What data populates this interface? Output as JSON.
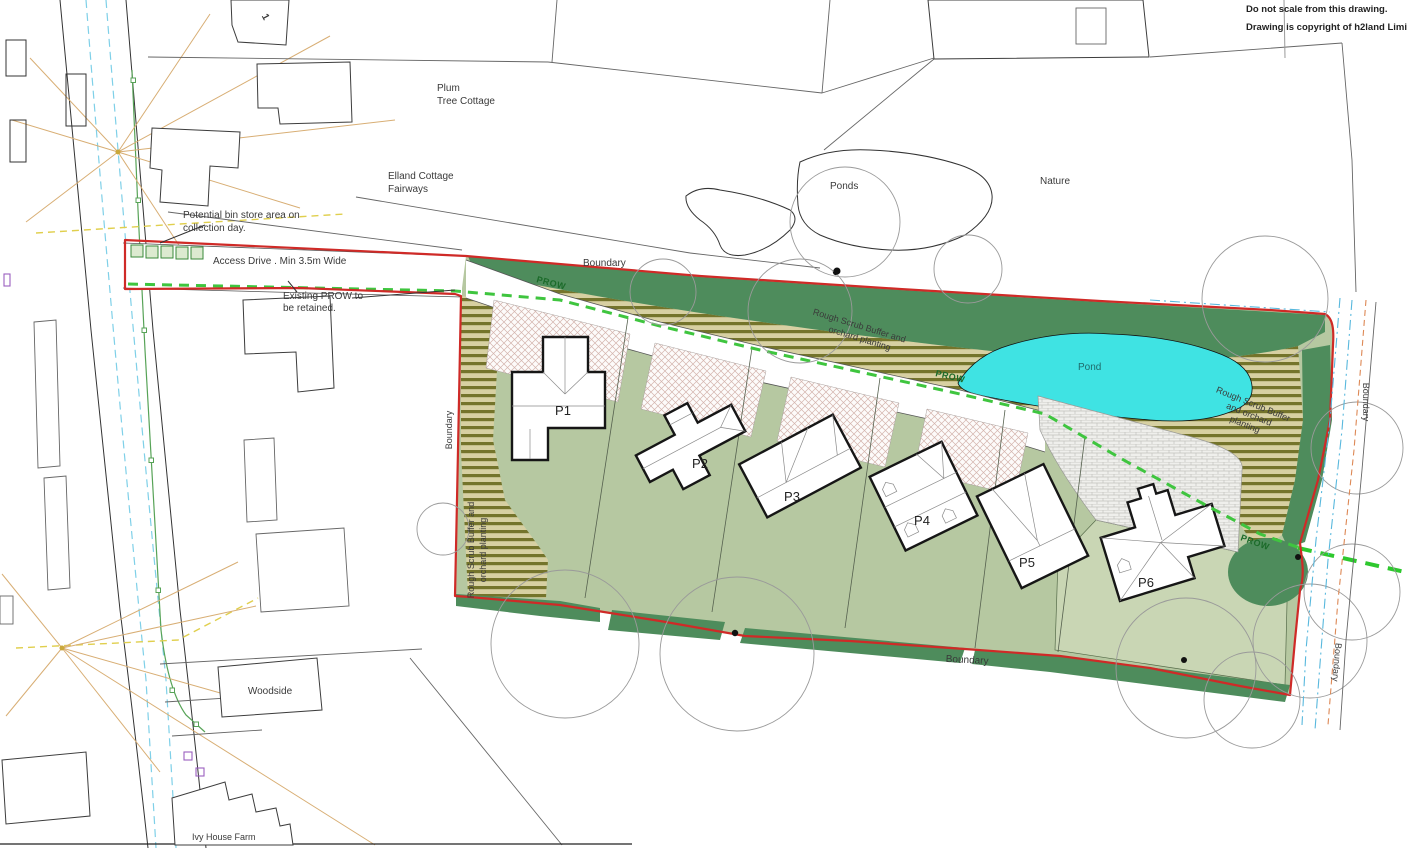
{
  "title_notes": {
    "line1": "Do not scale from this drawing.",
    "line2": "Drawing is copyright of h2land Limited"
  },
  "context_labels": {
    "house_number": "1",
    "plum_line1": "Plum",
    "plum_line2": "Tree Cottage",
    "elland_line1": "Elland Cottage",
    "elland_line2": "Fairways",
    "ponds": "Ponds",
    "nature": "Nature",
    "woodside": "Woodside",
    "ivy_house_farm": "Ivy House Farm"
  },
  "site_labels": {
    "bin_line1": "Potential bin store area on",
    "bin_line2": "collection day.",
    "access_drive": "Access Drive . Min 3.5m Wide",
    "prow_retained_line1": "Existing PROW to",
    "prow_retained_line2": "be retained.",
    "boundary": "Boundary",
    "prow": "PROW",
    "pond": "Pond",
    "scrub_line1": "Rough Scrub Buffer and",
    "scrub_line2": "orchard planting",
    "scrub_right_line1": "Rough Scrub Buffer",
    "scrub_right_line2": "and orchard",
    "scrub_right_line3": "planting"
  },
  "plots": [
    {
      "id": "P1"
    },
    {
      "id": "P2"
    },
    {
      "id": "P3"
    },
    {
      "id": "P4"
    },
    {
      "id": "P5"
    },
    {
      "id": "P6"
    }
  ],
  "colors": {
    "boundary_red": "#cf2a27",
    "hedge_green": "#4e8c5c",
    "scrub_olive": "#74742b",
    "scrub_bg": "#d7d0a2",
    "garden_green": "#b6c8a1",
    "garden_pale": "#c9d6b4",
    "pond_cyan": "#3fe3e3",
    "prow_green": "#2ec82e",
    "hatch_pink": "#d4b4ad",
    "paving_grey": "#c2c2bd"
  }
}
